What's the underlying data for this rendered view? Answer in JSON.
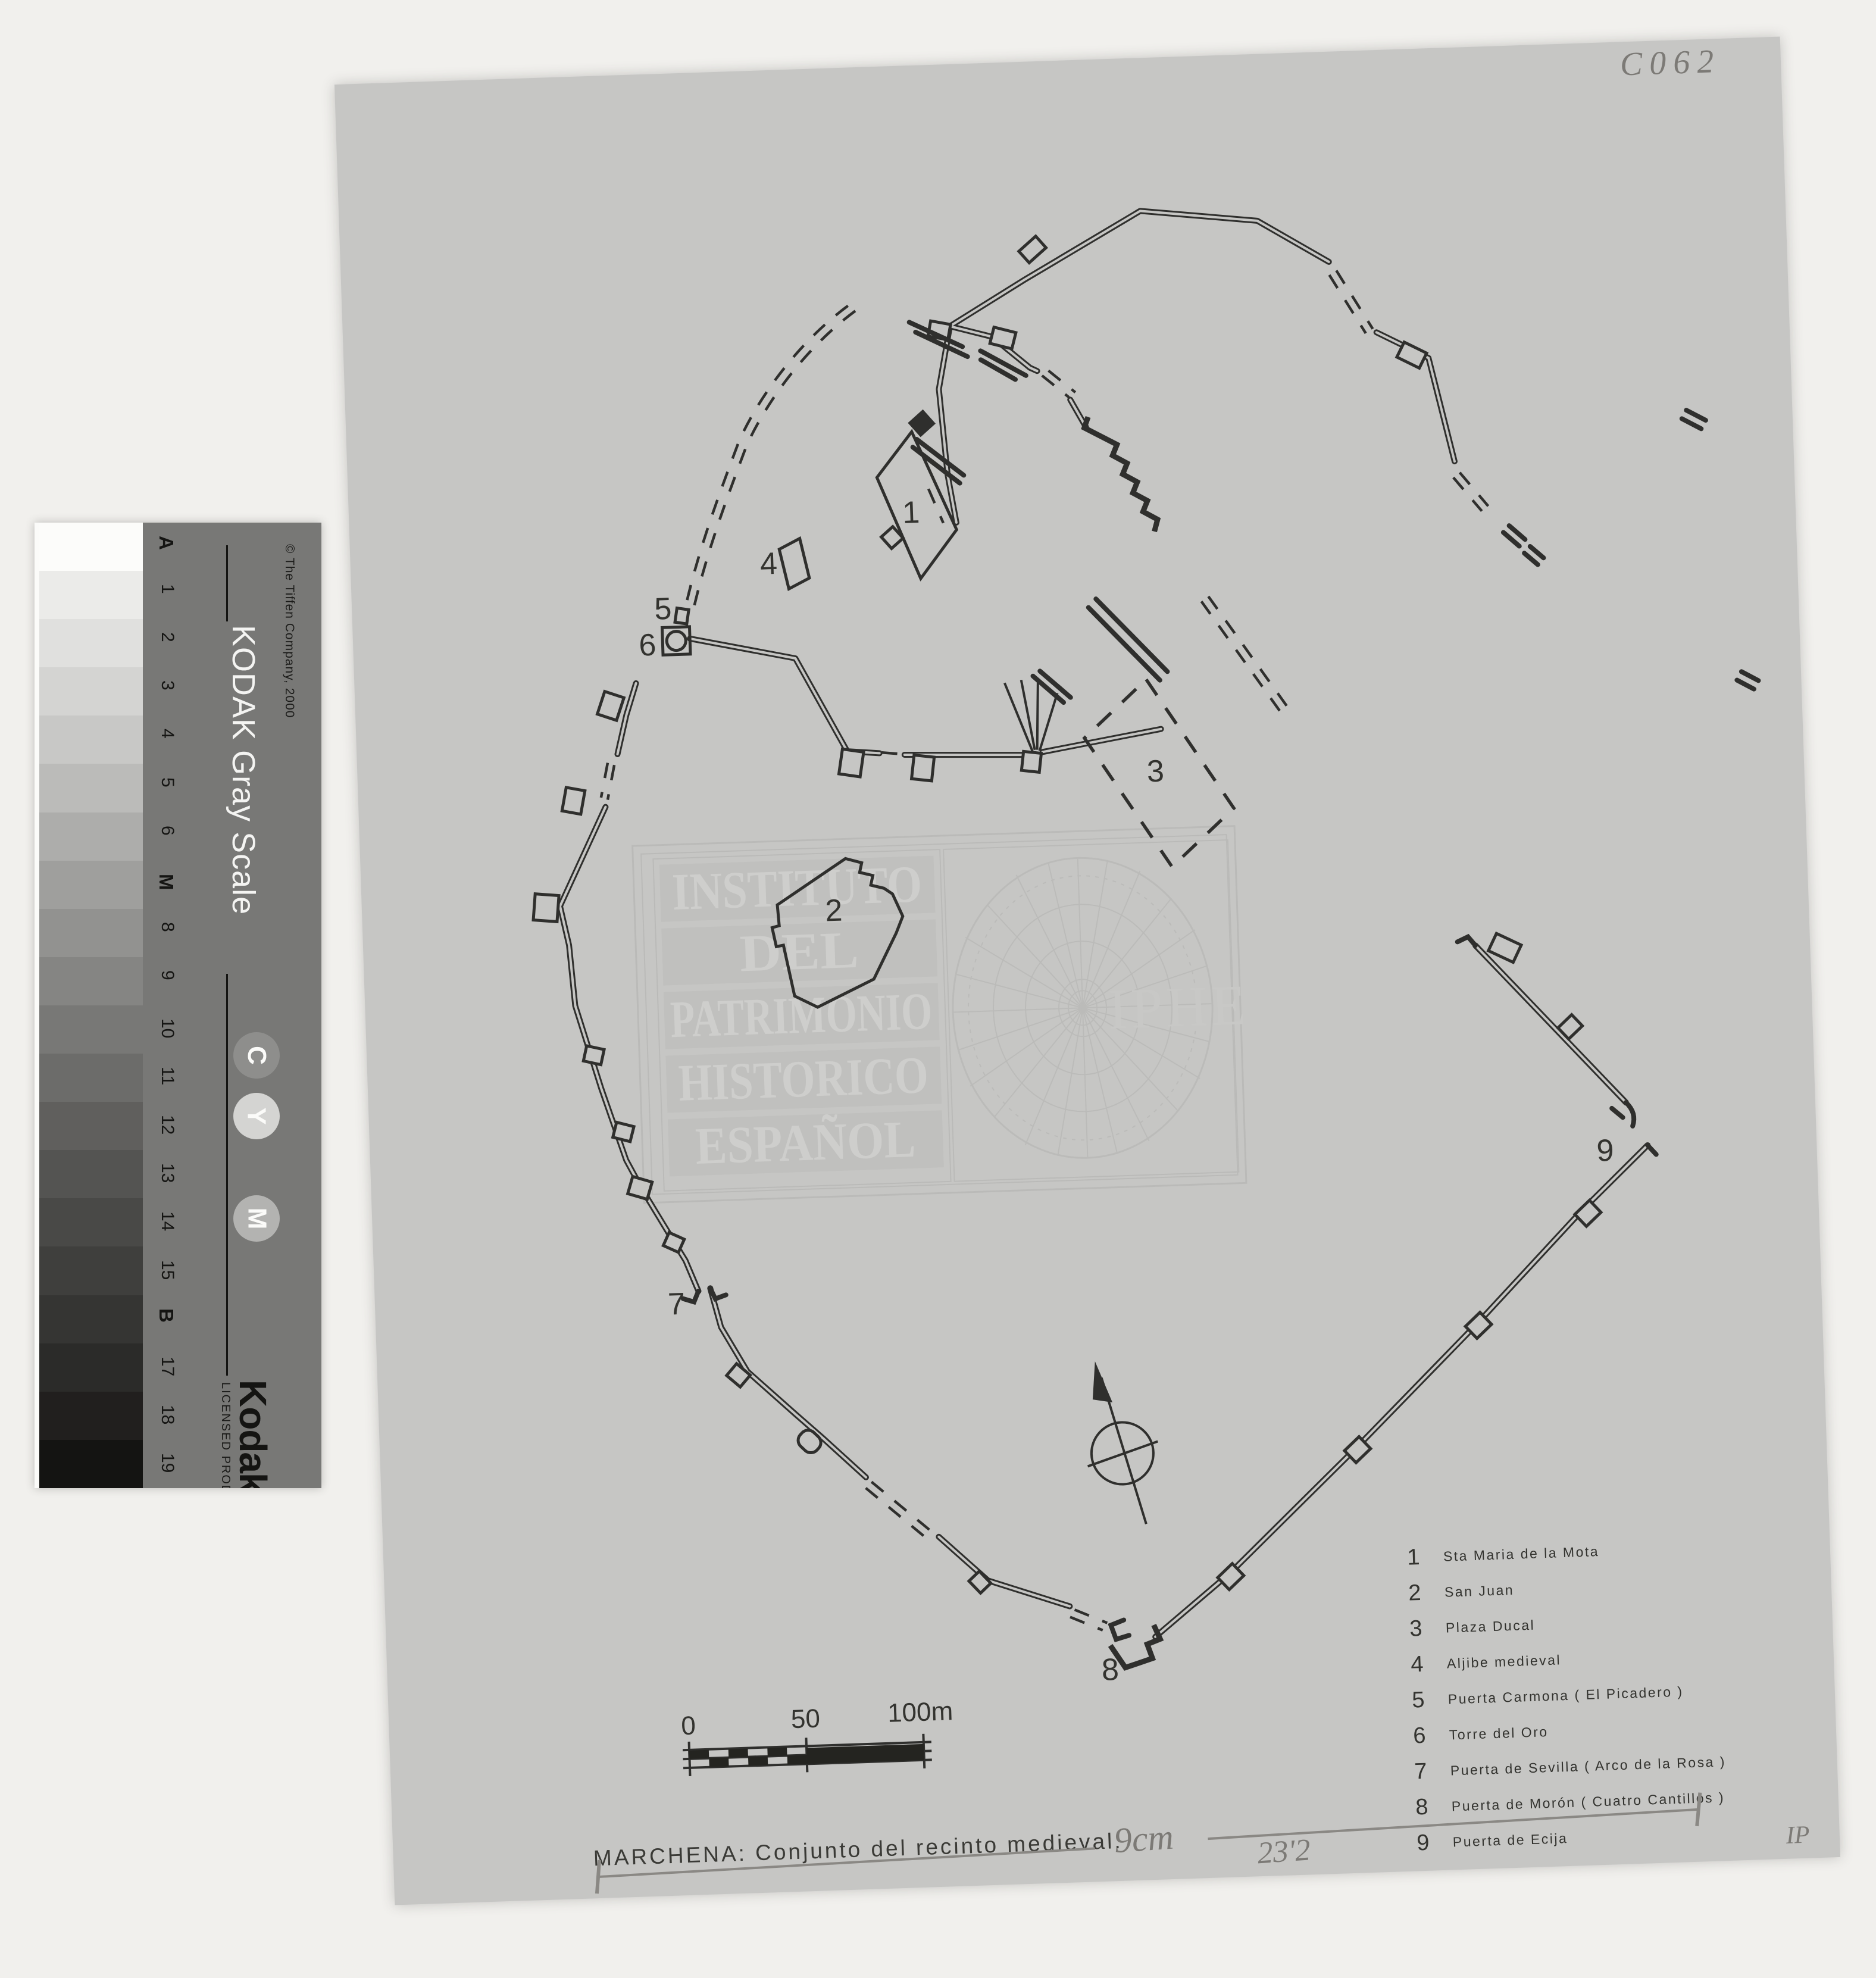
{
  "colors": {
    "backdrop": "#f1f0ed",
    "sheet": "#c6c6c4",
    "ink": "#2f2f2d",
    "pencil": "#8a8884",
    "kodak_band": "#787876"
  },
  "annotations": {
    "archive_code": "C062",
    "length_note": "9cm",
    "width_note": "23'2",
    "corner_mark": "IP"
  },
  "kodak": {
    "title": "KODAK Gray Scale",
    "copyright": "© The Tiffen Company, 2000",
    "brand": "Kodak",
    "licensed": "LICENSED PRODUCT",
    "circles": [
      {
        "label": "C",
        "hex": "#8e8e8c"
      },
      {
        "label": "Y",
        "hex": "#d4d4d2"
      },
      {
        "label": "M",
        "hex": "#b3b3b1"
      }
    ],
    "patches": [
      {
        "label": "A",
        "hex": "#fcfcfa"
      },
      {
        "label": "1",
        "hex": "#ebebe9"
      },
      {
        "label": "2",
        "hex": "#e0e0de"
      },
      {
        "label": "3",
        "hex": "#d4d4d2"
      },
      {
        "label": "4",
        "hex": "#c8c8c6"
      },
      {
        "label": "5",
        "hex": "#bbbbb9"
      },
      {
        "label": "6",
        "hex": "#adadab"
      },
      {
        "label": "M",
        "hex": "#9f9f9d"
      },
      {
        "label": "8",
        "hex": "#929290"
      },
      {
        "label": "9",
        "hex": "#858583"
      },
      {
        "label": "10",
        "hex": "#787876"
      },
      {
        "label": "11",
        "hex": "#6c6c6a"
      },
      {
        "label": "12",
        "hex": "#605f5d"
      },
      {
        "label": "13",
        "hex": "#545452"
      },
      {
        "label": "14",
        "hex": "#494947"
      },
      {
        "label": "15",
        "hex": "#3f3f3d"
      },
      {
        "label": "B",
        "hex": "#353533"
      },
      {
        "label": "17",
        "hex": "#2b2b29"
      },
      {
        "label": "18",
        "hex": "#211f1e"
      },
      {
        "label": "19",
        "hex": "#141412"
      }
    ]
  },
  "watermark": {
    "lines": [
      "INSTITUTO",
      "DEL",
      "PATRIMONIO",
      "HISTORICO",
      "ESPAÑOL"
    ],
    "acronym": "IPHE"
  },
  "map": {
    "caption": "MARCHENA: Conjunto del recinto medieval.",
    "scale_bar": {
      "start": "0",
      "mid": "50",
      "end": "100m"
    },
    "point_labels": [
      "1",
      "2",
      "3",
      "4",
      "5",
      "6",
      "7",
      "8",
      "9"
    ],
    "legend": [
      {
        "num": "1",
        "label": "Sta Maria de la Mota"
      },
      {
        "num": "2",
        "label": "San Juan"
      },
      {
        "num": "3",
        "label": "Plaza Ducal"
      },
      {
        "num": "4",
        "label": "Aljibe medieval"
      },
      {
        "num": "5",
        "label": "Puerta Carmona ( El Picadero )"
      },
      {
        "num": "6",
        "label": "Torre del Oro"
      },
      {
        "num": "7",
        "label": "Puerta de Sevilla ( Arco de la Rosa )"
      },
      {
        "num": "8",
        "label": "Puerta de Morón ( Cuatro Cantillos )"
      },
      {
        "num": "9",
        "label": "Puerta de Ecija"
      }
    ]
  }
}
